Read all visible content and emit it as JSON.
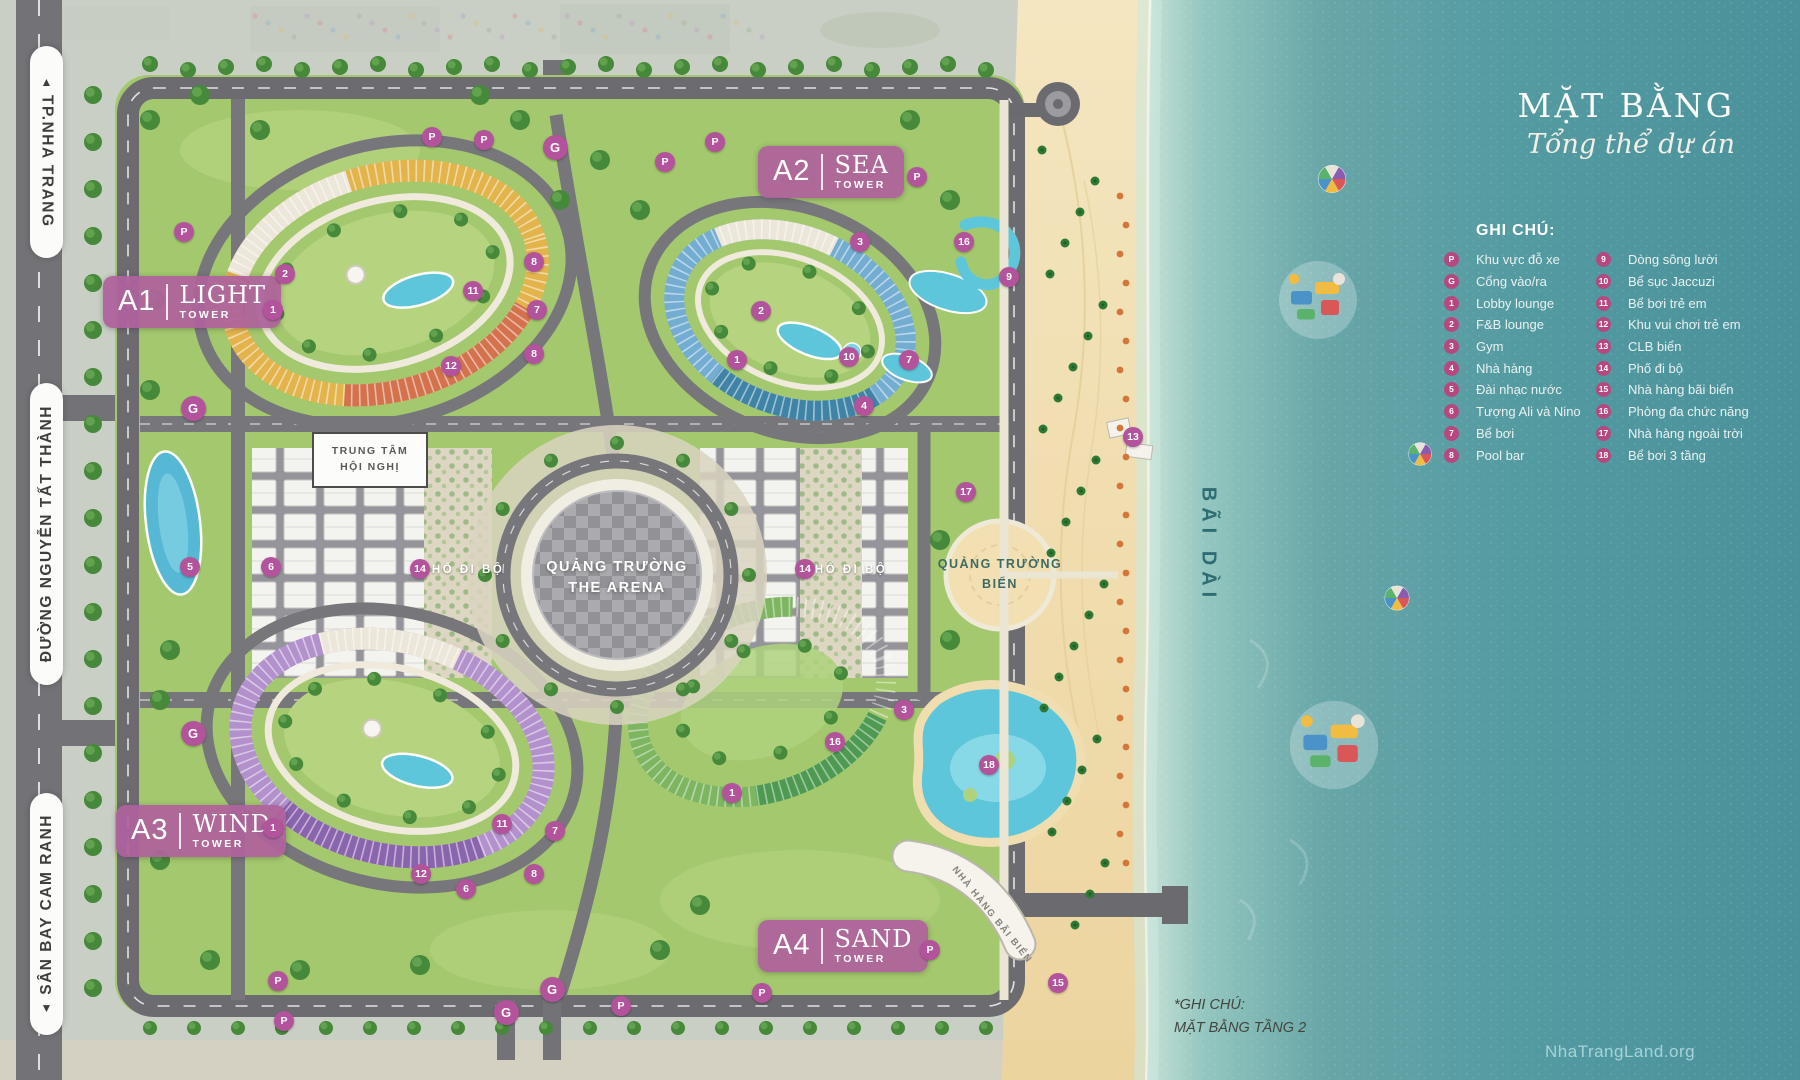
{
  "title": {
    "main": "MẶT BẰNG",
    "subtitle": "Tổng thể dự án"
  },
  "legend": {
    "heading": "GHI CHÚ:",
    "items_left": [
      {
        "key": "P",
        "label": "Khu vực đỗ xe"
      },
      {
        "key": "G",
        "label": "Cổng vào/ra"
      },
      {
        "key": "1",
        "label": "Lobby lounge"
      },
      {
        "key": "2",
        "label": "F&B lounge"
      },
      {
        "key": "3",
        "label": "Gym"
      },
      {
        "key": "4",
        "label": "Nhà hàng"
      },
      {
        "key": "5",
        "label": "Đài nhạc nước"
      },
      {
        "key": "6",
        "label": "Tượng Ali và Nino"
      },
      {
        "key": "7",
        "label": "Bể bơi"
      },
      {
        "key": "8",
        "label": "Pool bar"
      }
    ],
    "items_right": [
      {
        "key": "9",
        "label": "Dòng sông lười"
      },
      {
        "key": "10",
        "label": "Bể sục Jaccuzi"
      },
      {
        "key": "11",
        "label": "Bể bơi trẻ em"
      },
      {
        "key": "12",
        "label": "Khu vui chơi trẻ em"
      },
      {
        "key": "13",
        "label": "CLB biển"
      },
      {
        "key": "14",
        "label": "Phố đi bộ"
      },
      {
        "key": "15",
        "label": "Nhà hàng bãi biển"
      },
      {
        "key": "16",
        "label": "Phòng đa chức năng"
      },
      {
        "key": "17",
        "label": "Nhà hàng ngoài trời"
      },
      {
        "key": "18",
        "label": "Bể bơi 3 tầng"
      }
    ]
  },
  "towers": [
    {
      "code": "A1",
      "name": "LIGHT",
      "sub": "TOWER"
    },
    {
      "code": "A2",
      "name": "SEA",
      "sub": "TOWER"
    },
    {
      "code": "A3",
      "name": "WIND",
      "sub": "TOWER"
    },
    {
      "code": "A4",
      "name": "SAND",
      "sub": "TOWER"
    }
  ],
  "roads": [
    {
      "label": "TP.NHA TRANG",
      "arrow": "▲"
    },
    {
      "label": "ĐƯỜNG NGUYỄN TẤT THÀNH",
      "arrow": ""
    },
    {
      "label": "SÂN BAY CAM RANH",
      "arrow": "▼"
    }
  ],
  "map_labels": {
    "arena_line1": "QUẢNG TRƯỜNG",
    "arena_line2": "THE ARENA",
    "conference_line1": "TRUNG TÂM",
    "conference_line2": "HỘI NGHỊ",
    "walking_street": "PHỐ ĐI BỘ",
    "beach_square_line1": "QUẢNG TRƯỜNG",
    "beach_square_line2": "BIỂN",
    "beach_name": "BÃI DÀI",
    "beach_restaurant": "NHÀ HÀNG BÃI BIỂN"
  },
  "note": {
    "line1": "*GHI CHÚ:",
    "line2": "MẶT BẰNG TẦNG 2"
  },
  "watermark": "NhaTrangLand.org",
  "colors": {
    "marker": "#b3539b",
    "legend_bullet": "#b5487e",
    "tower_box": "#ae639c",
    "sea_deep": "#4a919b",
    "sand": "#f0dcab"
  },
  "markers": [
    {
      "t": "P",
      "x": 184,
      "y": 232
    },
    {
      "t": "P",
      "x": 432,
      "y": 137
    },
    {
      "t": "P",
      "x": 484,
      "y": 140
    },
    {
      "t": "P",
      "x": 665,
      "y": 162
    },
    {
      "t": "P",
      "x": 715,
      "y": 142
    },
    {
      "t": "P",
      "x": 917,
      "y": 177
    },
    {
      "t": "P",
      "x": 930,
      "y": 950
    },
    {
      "t": "P",
      "x": 762,
      "y": 993
    },
    {
      "t": "P",
      "x": 621,
      "y": 1006
    },
    {
      "t": "P",
      "x": 284,
      "y": 1021
    },
    {
      "t": "P",
      "x": 278,
      "y": 981
    },
    {
      "t": "G",
      "x": 555,
      "y": 147
    },
    {
      "t": "G",
      "x": 193,
      "y": 408
    },
    {
      "t": "G",
      "x": 193,
      "y": 733
    },
    {
      "t": "G",
      "x": 552,
      "y": 989
    },
    {
      "t": "G",
      "x": 506,
      "y": 1012
    },
    {
      "t": "1",
      "x": 273,
      "y": 310
    },
    {
      "t": "1",
      "x": 737,
      "y": 360
    },
    {
      "t": "1",
      "x": 273,
      "y": 828
    },
    {
      "t": "1",
      "x": 732,
      "y": 793
    },
    {
      "t": "2",
      "x": 285,
      "y": 274
    },
    {
      "t": "2",
      "x": 761,
      "y": 311
    },
    {
      "t": "3",
      "x": 860,
      "y": 242
    },
    {
      "t": "3",
      "x": 904,
      "y": 710
    },
    {
      "t": "4",
      "x": 864,
      "y": 406
    },
    {
      "t": "5",
      "x": 190,
      "y": 567
    },
    {
      "t": "6",
      "x": 271,
      "y": 567
    },
    {
      "t": "6",
      "x": 466,
      "y": 889
    },
    {
      "t": "7",
      "x": 537,
      "y": 310
    },
    {
      "t": "7",
      "x": 909,
      "y": 360
    },
    {
      "t": "7",
      "x": 555,
      "y": 831
    },
    {
      "t": "8",
      "x": 534,
      "y": 262
    },
    {
      "t": "8",
      "x": 534,
      "y": 354
    },
    {
      "t": "8",
      "x": 534,
      "y": 874
    },
    {
      "t": "9",
      "x": 1009,
      "y": 277
    },
    {
      "t": "10",
      "x": 849,
      "y": 357
    },
    {
      "t": "11",
      "x": 473,
      "y": 291
    },
    {
      "t": "11",
      "x": 502,
      "y": 824
    },
    {
      "t": "12",
      "x": 451,
      "y": 366
    },
    {
      "t": "12",
      "x": 421,
      "y": 874
    },
    {
      "t": "13",
      "x": 1133,
      "y": 437
    },
    {
      "t": "14",
      "x": 420,
      "y": 569
    },
    {
      "t": "14",
      "x": 805,
      "y": 569
    },
    {
      "t": "15",
      "x": 1058,
      "y": 983
    },
    {
      "t": "16",
      "x": 964,
      "y": 242
    },
    {
      "t": "16",
      "x": 835,
      "y": 742
    },
    {
      "t": "17",
      "x": 966,
      "y": 492
    },
    {
      "t": "18",
      "x": 989,
      "y": 765
    }
  ]
}
